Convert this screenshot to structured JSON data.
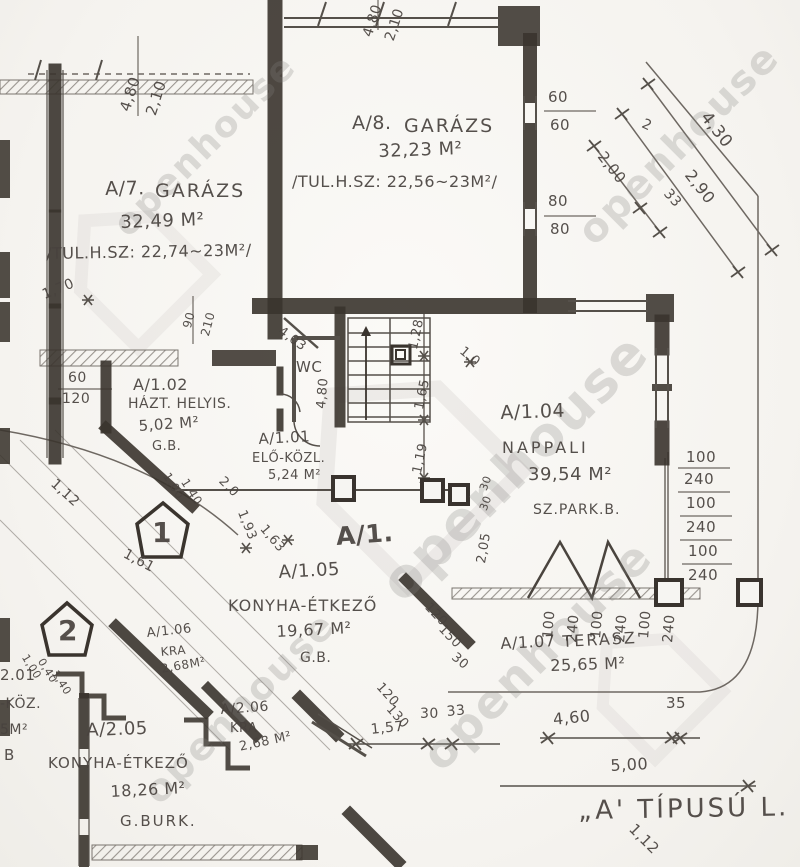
{
  "watermark": {
    "text": "openhouse"
  },
  "plan": {
    "title": "„A' TÍPUSÚ L.",
    "unit_label": "A/1.",
    "marker1": "1",
    "marker2": "2"
  },
  "rooms": {
    "a7": {
      "id": "A/7.",
      "name": "GARÁZS",
      "area": "32,49 M²",
      "note": "/TUL.H.SZ: 22,74~23M²/"
    },
    "a8": {
      "id": "A/8.",
      "name": "GARÁZS",
      "area": "32,23 M²",
      "note": "/TUL.H.SZ: 22,56~23M²/"
    },
    "a102": {
      "id": "A/1.02",
      "name": "HÁZT. HELYIS.",
      "area": "5,02 M²",
      "floor": "G.B."
    },
    "a101": {
      "id": "A/1.01",
      "name": "ELŐ-KÖZL.",
      "area": "5,24 M²"
    },
    "a104": {
      "id": "A/1.04",
      "name": "NAPPALI",
      "area": "39,54 M²",
      "floor": "SZ.PARK.B."
    },
    "a105": {
      "id": "A/1.05",
      "name": "KONYHA-ÉTKEZŐ",
      "area": "19,67 M²",
      "floor": "G.B."
    },
    "a106": {
      "id": "A/1.06",
      "name": "KRA",
      "area": "2,68M²"
    },
    "a107": {
      "id": "A/1.07",
      "name": "TERASZ",
      "area": "25,65 M²"
    },
    "a205": {
      "id": "A/2.05",
      "name": "KONYHA-ÉTKEZŐ",
      "area": "18,26 M²",
      "floor": "G.BURK."
    },
    "a206": {
      "id": "A/2.06",
      "name": "KRA",
      "area": "2,68 M²"
    },
    "wc": {
      "name": "WC"
    }
  },
  "partials": {
    "p1": "2.01",
    "p2": "-KÖZ.",
    "p3": "5M²",
    "p4": "B"
  },
  "dims": {
    "a7_door": [
      "4,80",
      "2,10"
    ],
    "a8_door": [
      "4,80",
      "2,10"
    ],
    "a8_windows": [
      "60",
      "60",
      "80",
      "80"
    ],
    "diag": [
      "2",
      "4,30",
      "2,90",
      "2,00",
      "33"
    ],
    "d170": "1,70",
    "d60": "60",
    "d120": "120",
    "door_a102": [
      "90",
      "210"
    ],
    "d403": "4,03",
    "d480": "4,80",
    "stair_col": [
      "1,28",
      "1,65",
      "1,19"
    ],
    "d10": "1,0",
    "d30a": "30",
    "d30b": "30",
    "d205": "2,05",
    "right_col": [
      "100",
      "240",
      "100",
      "240",
      "100",
      "240"
    ],
    "terrace_row": [
      "100",
      "240",
      "100",
      "240",
      "100",
      "240"
    ],
    "d112": "1,12",
    "d100": "1,00",
    "d140": "1,40",
    "d20": "2,0",
    "d161": "1,61",
    "d193": "1,93",
    "d163": "1,63",
    "p2_dims": [
      "1,00",
      "0,40",
      "1,40"
    ],
    "terr_left": [
      "120",
      "150",
      "30"
    ],
    "b120": "120",
    "b130": "130",
    "d157": "1,57",
    "b30": "30",
    "b33": "33",
    "d460": "4,60",
    "d35": "35",
    "d500": "5,00",
    "b112": "1,12"
  }
}
